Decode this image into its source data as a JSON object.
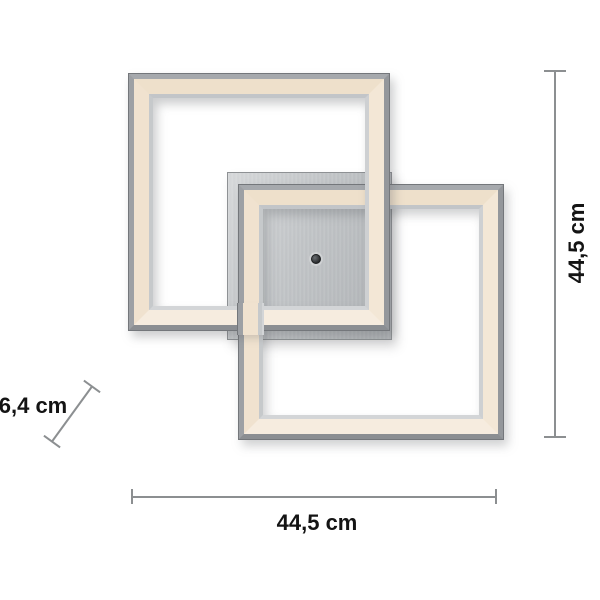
{
  "diagram": {
    "subject": "led-ceiling-light-two-interlocked-square-frames",
    "dimensions": {
      "width": {
        "label": "44,5 cm",
        "position": "bottom"
      },
      "height": {
        "label": "44,5 cm",
        "position": "right"
      },
      "depth": {
        "label": "6,4 cm",
        "position": "left-diagonal"
      }
    }
  },
  "colors": {
    "background": "#ffffff",
    "chrome_frame": "#9da0a4",
    "chrome_edge_dark": "#74777b",
    "led_band_warm_white": "#f0e2cf",
    "inner_chrome": "#c6c9cb",
    "mounting_plate": "#c2c5c8",
    "sensor_dot": "#26282a",
    "dimension_line": "#8c8f91",
    "dimension_text": "#141414"
  }
}
